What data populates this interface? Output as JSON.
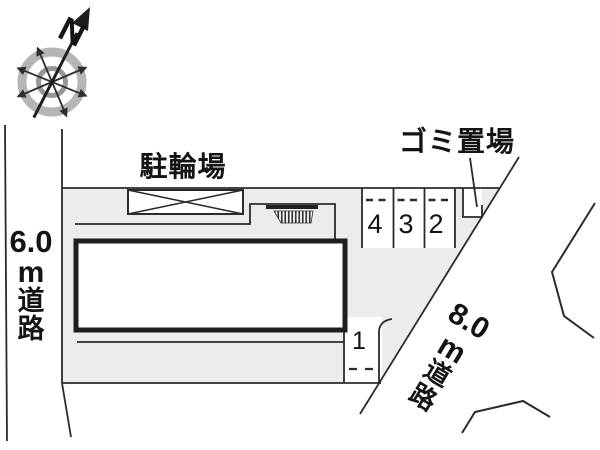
{
  "compass": {
    "north_label": "N"
  },
  "site": {
    "bicycle_parking_label": "駐輪場",
    "garbage_area_label": "ゴミ置場",
    "west_road": {
      "width": "6.0",
      "unit": "m",
      "kanji_do": "道",
      "kanji_ro": "路"
    },
    "southeast_road": {
      "width": "8.0",
      "unit": "m",
      "kanji_do": "道",
      "kanji_ro": "路"
    },
    "parking_spaces": {
      "space4": "4",
      "space3": "3",
      "space2": "2",
      "space1": "1"
    }
  },
  "colors": {
    "parcel_fill": "#ececec",
    "line": "#2b2b2b",
    "building_outline": "#1e1e1e",
    "compass_ring_outer": "#b5b5b5",
    "compass_ring_inner": "#979797"
  }
}
